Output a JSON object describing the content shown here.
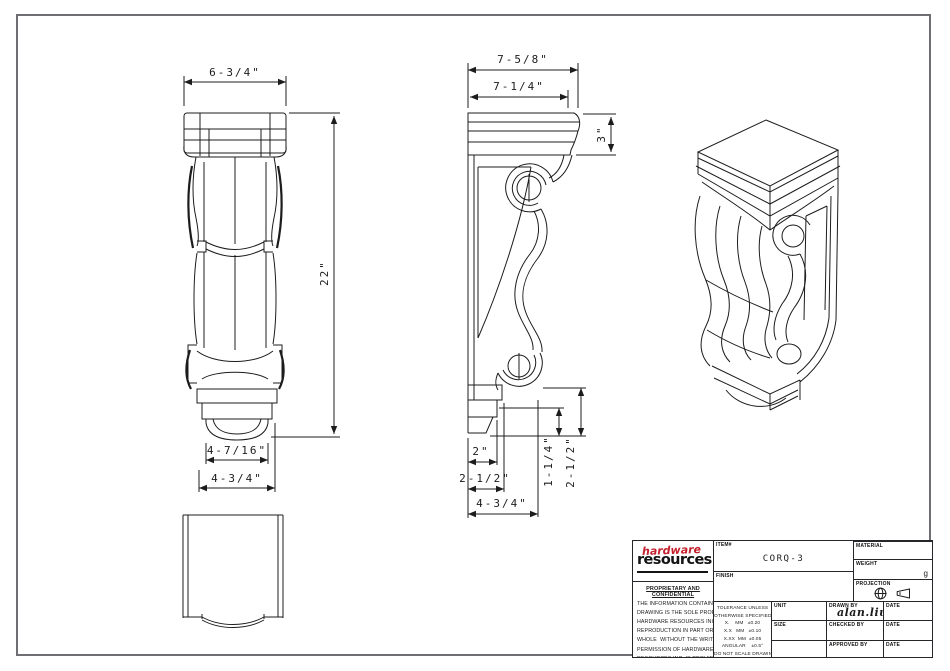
{
  "page": {
    "background": "#ffffff",
    "border_color": "#6f6f73",
    "line_color": "#1c1c1e"
  },
  "views": {
    "front": {
      "dims": {
        "width_top": "6-3/4\"",
        "height": "22\"",
        "bottom_inner": "4-7/16\"",
        "bottom_outer": "4-3/4\""
      }
    },
    "side": {
      "dims": {
        "depth_outer": "7-5/8\"",
        "depth_inner": "7-1/4\"",
        "cap_height": "3\"",
        "foot_a": "2\"",
        "foot_b": "2-1/2\"",
        "foot_c": "4-3/4\"",
        "rise_a": "1-1/4\"",
        "rise_b": "2-1/2\""
      }
    }
  },
  "title_block": {
    "logo": {
      "word1": "hardware",
      "word2": "resources",
      "accent_color": "#c3202c"
    },
    "labels": {
      "item": "ITEM#",
      "finish": "FINISH",
      "material": "MATERIAL",
      "weight": "WEIGHT",
      "projection": "PROJECTION",
      "unit": "UNIT",
      "size": "SIZE",
      "drawn_by": "DRAWN BY",
      "checked_by": "CHECKED BY",
      "approved_by": "APPROVED BY",
      "date": "DATE"
    },
    "values": {
      "item": "CORQ-3",
      "weight_unit": "g",
      "drawn_by": "alan.liu"
    },
    "proprietary": {
      "heading": "PROPRIETARY AND CONFIDENTIAL",
      "lines": [
        "THE INFORMATION CONTAINED IN THIS",
        "DRAWING IS THE SOLE PROPERTY OF",
        "HARDWARE RESOURCES INC.  ANY",
        "REPRODUCTION IN PART OR AS A",
        "WHOLE  WITHOUT THE WRITTEN",
        "PERMISSION OF HARDWARE",
        "RESOURCES INC  IS PROHIBITED"
      ]
    },
    "tolerance": {
      "lines": [
        "TOLERANCE UNLESS",
        "OTHERWISE SPECIFIED",
        "X.    MM   ±0.20",
        "X.X   MM   ±0.10",
        "X.XX  MM  ±0.05",
        "ANGULAR    ±0.5°",
        "DO NOT SCALE DRAWING"
      ]
    }
  }
}
